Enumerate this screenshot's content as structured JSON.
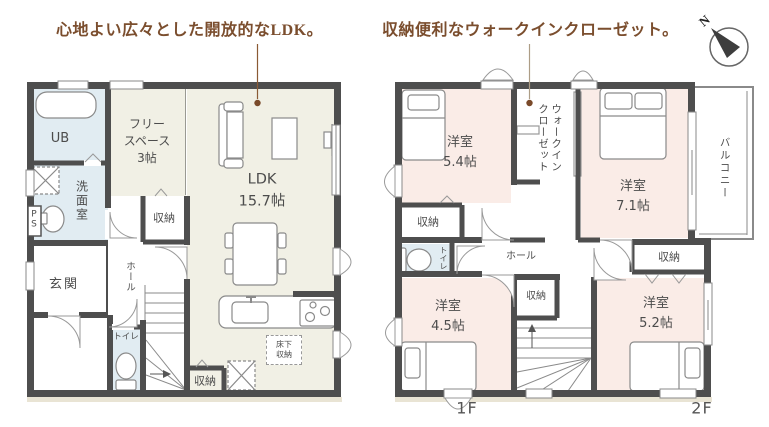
{
  "annotations": {
    "ldk": "心地よい広々とした開放的なLDK。",
    "wic": "収納便利なウォークインクローゼット。"
  },
  "compass": {
    "north": "N"
  },
  "floor1": {
    "label": "1F",
    "rooms": {
      "ub": "UB",
      "free_space": "フリー\nスペース\n3帖",
      "ldk": "LDK\n15.7帖",
      "washroom": "洗面室",
      "ps": "P\nS",
      "storage_mid": "収納",
      "entrance": "玄関",
      "hall": "ホール",
      "toilet": "トイレ",
      "storage_bottom": "収納",
      "underfloor_storage": "床下\n収納"
    }
  },
  "floor2": {
    "label": "2F",
    "rooms": {
      "bedroom_54": "洋室\n5.4帖",
      "walk_in_closet": "ウォークイン\nクローゼット",
      "bedroom_71": "洋室\n7.1帖",
      "balcony": "バルコニー",
      "storage_54": "収納",
      "toilet": "トイレ",
      "hall": "ホール",
      "storage_52": "収納",
      "bedroom_45": "洋室\n4.5帖",
      "storage_center": "収納",
      "bedroom_52": "洋室\n5.2帖"
    }
  }
}
